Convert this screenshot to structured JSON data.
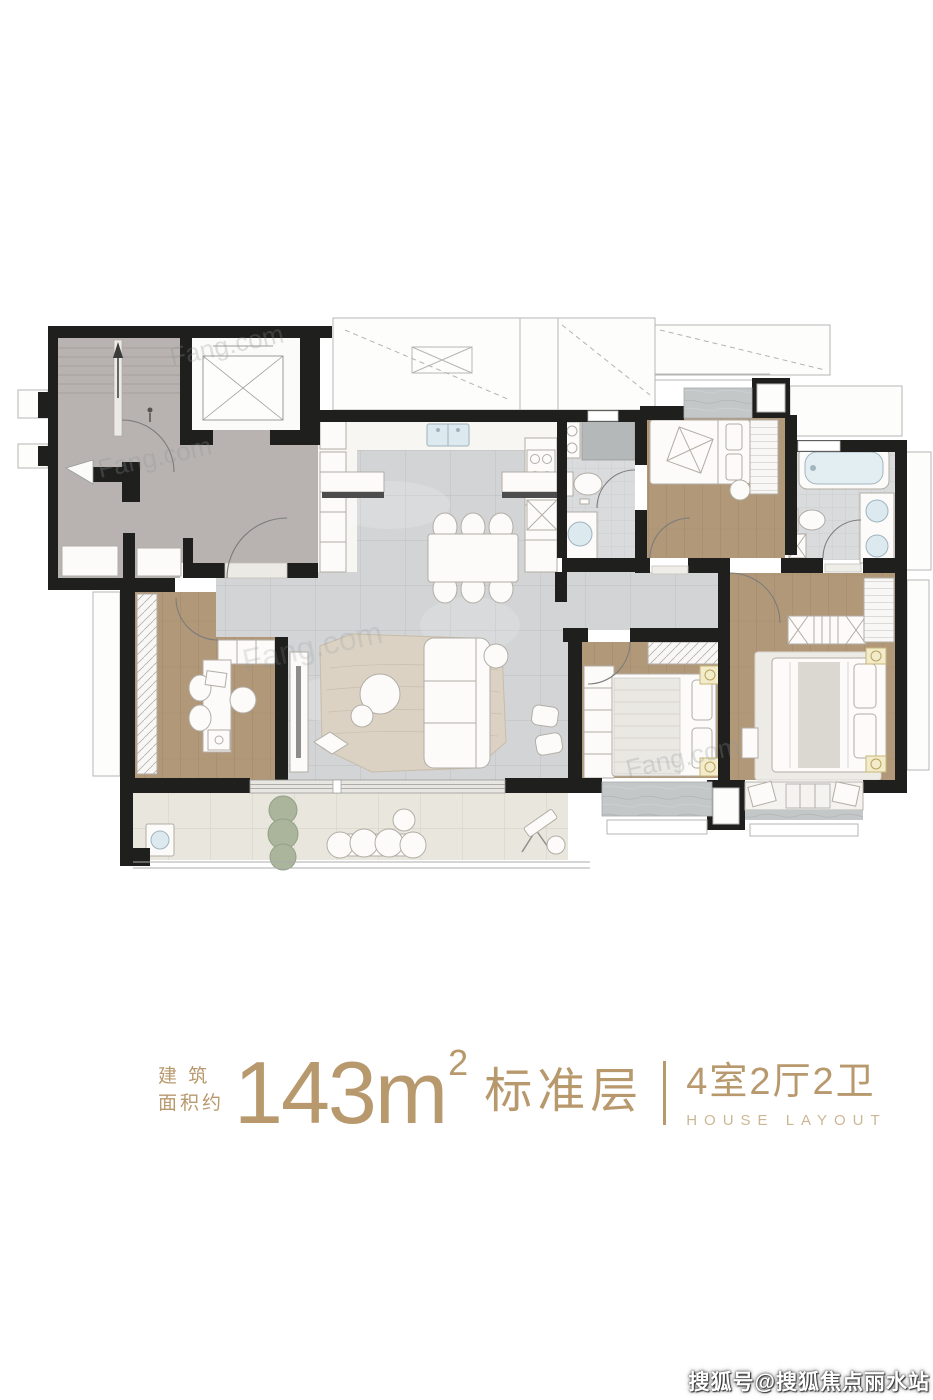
{
  "page": {
    "background": "#ffffff"
  },
  "plan": {
    "ghost_watermark": "Fang.com",
    "colors": {
      "wall": "#1f1f1d",
      "core_gray": "#b8b3b0",
      "tile_gray": "#d2d4d5",
      "wood_tan": "#b19879",
      "balcony_beige": "#e9e6de",
      "bath_tile": "#dadbdc",
      "fixture_blue": "#dce9ef",
      "lamp_yellow": "#f3ecca",
      "rug_beige": "#dbd2c3",
      "plant_green": "#aab59b"
    }
  },
  "footer": {
    "build_label_top": "建 筑",
    "build_label_bottom": "面积约",
    "area_value": "143",
    "area_unit": "m",
    "area_exponent": "2",
    "floor_type": "标准层",
    "layout_spec": "4室2厅2卫",
    "layout_spec_en": "HOUSE LAYOUT",
    "accent_color": "#b8996d"
  },
  "overlay_watermark": {
    "text": "搜狐号@搜狐焦点丽水站"
  }
}
